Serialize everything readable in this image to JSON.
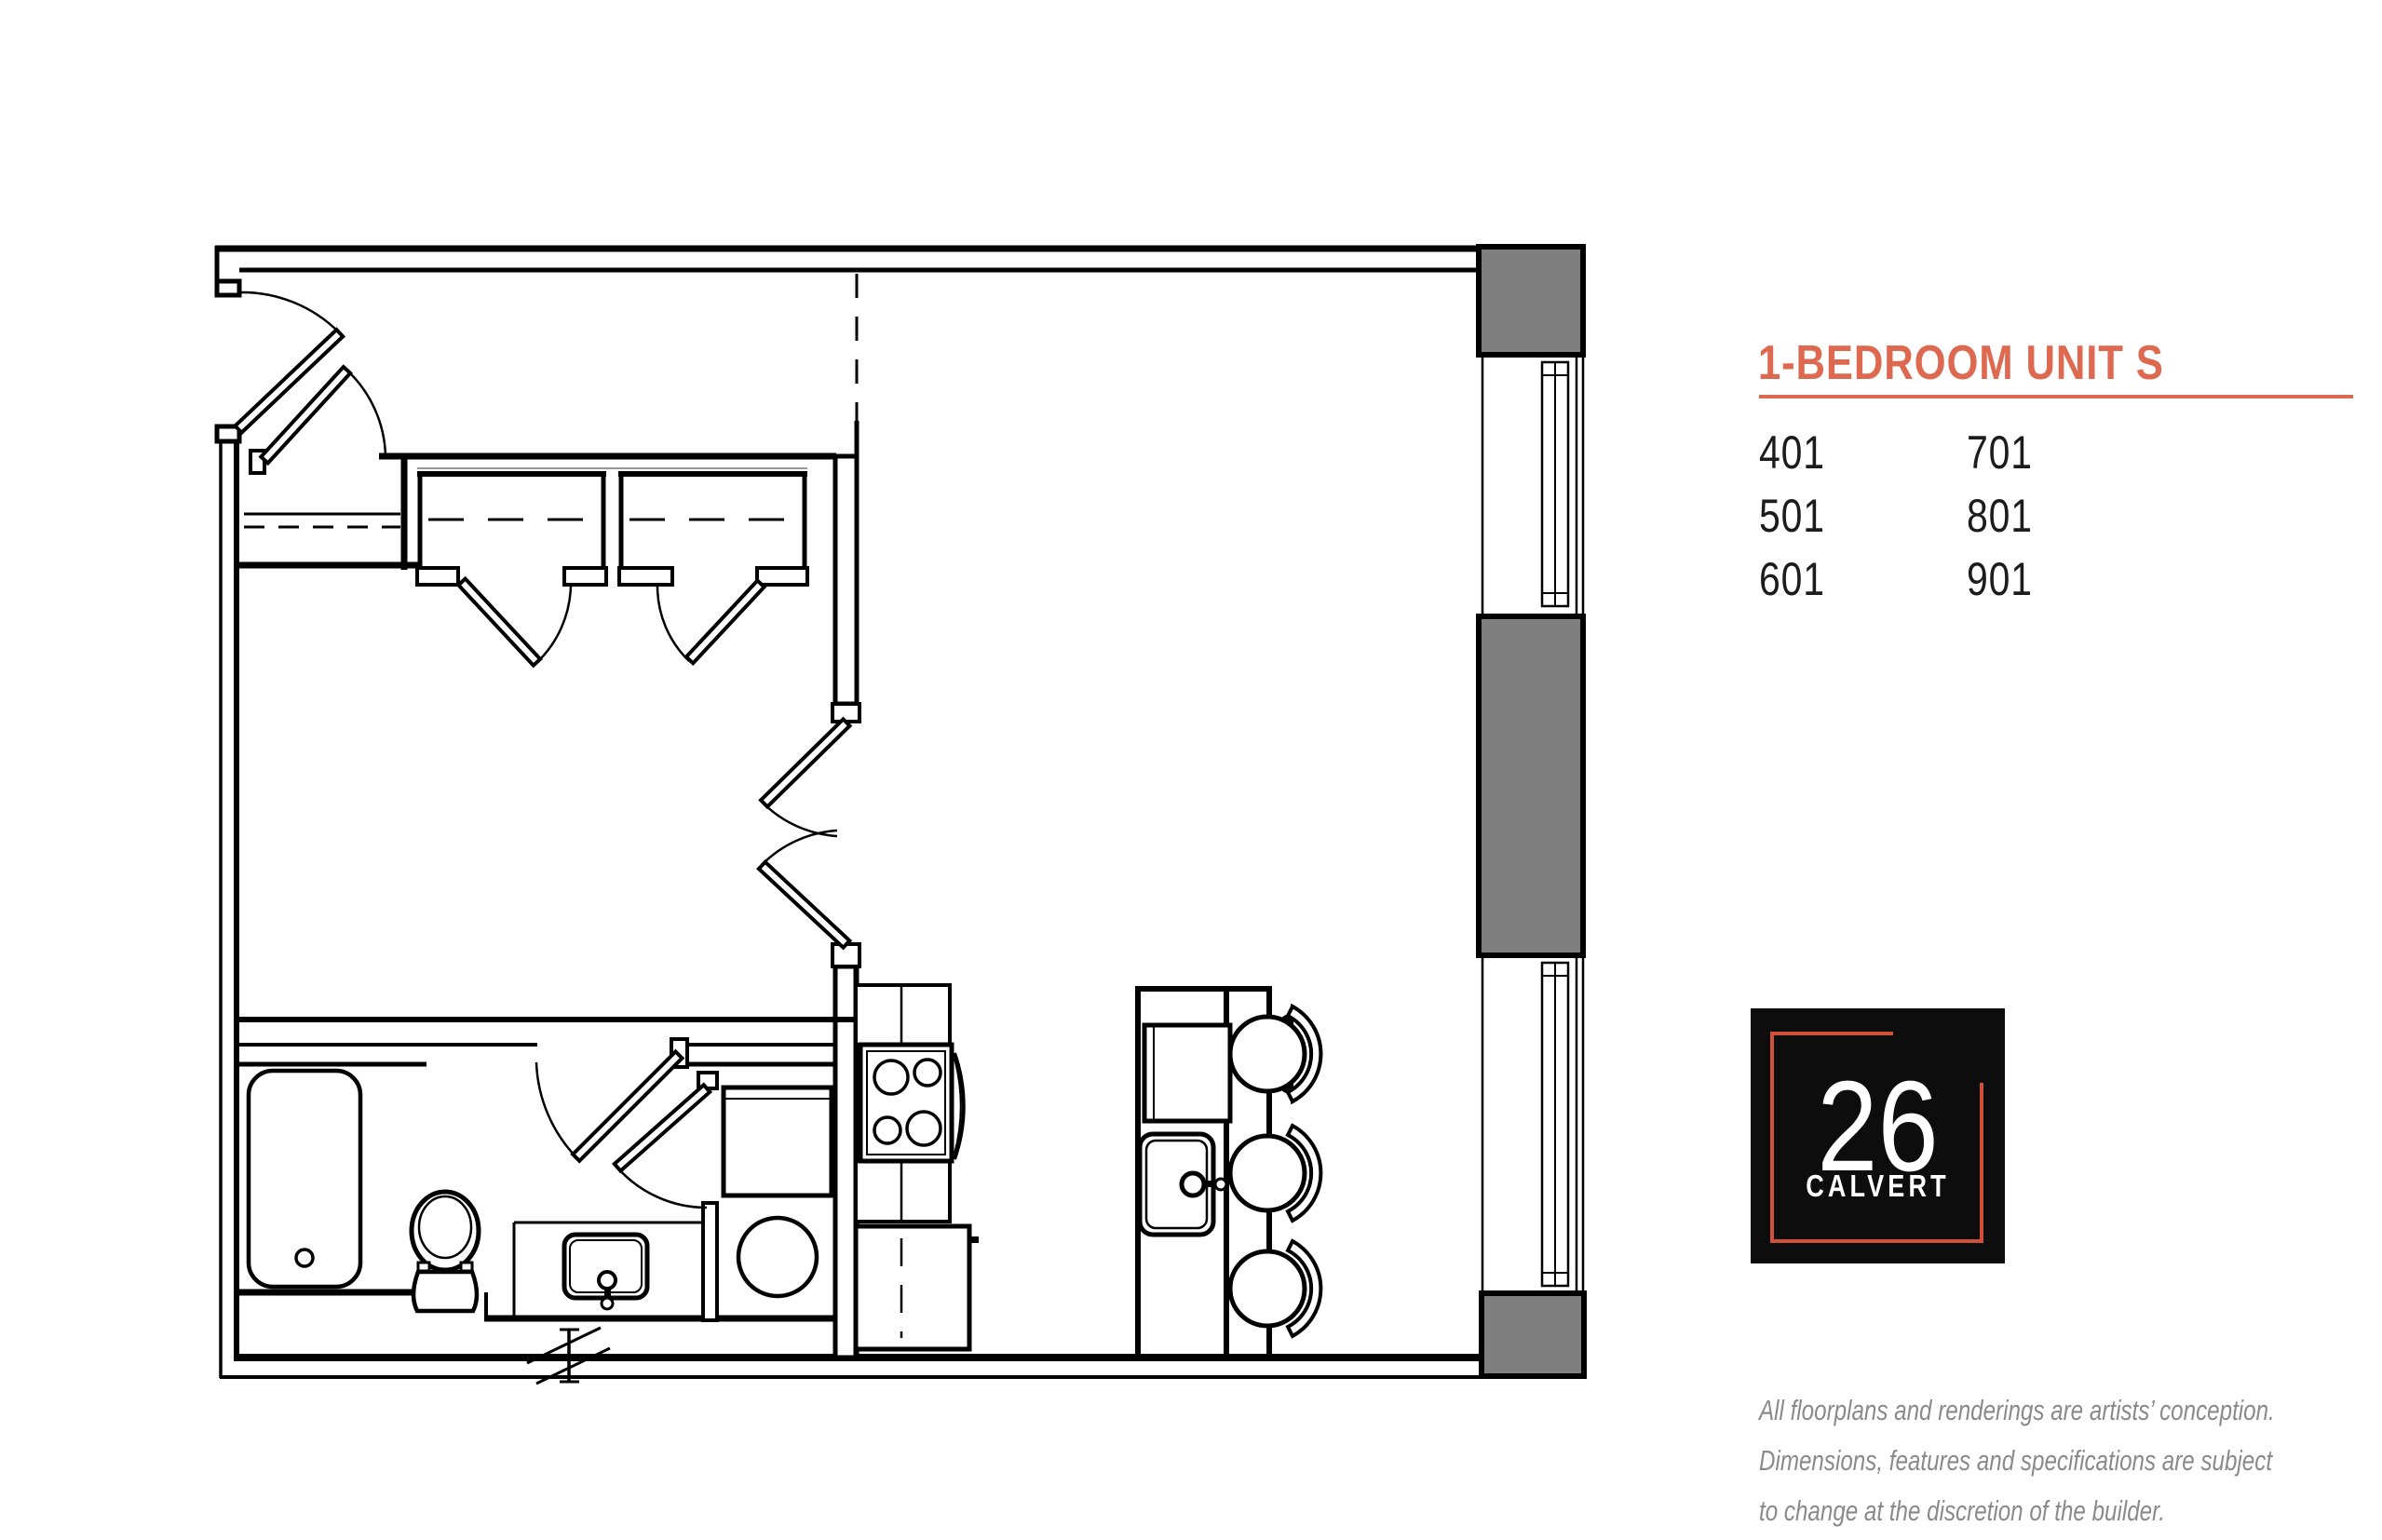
{
  "panel": {
    "title": "1-BEDROOM UNIT S",
    "units": {
      "col1": [
        "401",
        "501",
        "601"
      ],
      "col2": [
        "701",
        "801",
        "901"
      ]
    },
    "logo": {
      "number": "26",
      "name": "CALVERT"
    },
    "disclaimer": [
      "All floorplans and renderings are artists’ conception.",
      "Dimensions, features and specifications are subject",
      "to change at the discretion of the builder."
    ]
  },
  "colors": {
    "accent": "#DD6950",
    "logo_frame": "#D1503A",
    "logo_bg": "#0D0D0D",
    "gray_block": "#7F7F7F",
    "disclaimer_text": "#8A8A8A",
    "plan_line": "#000000"
  }
}
